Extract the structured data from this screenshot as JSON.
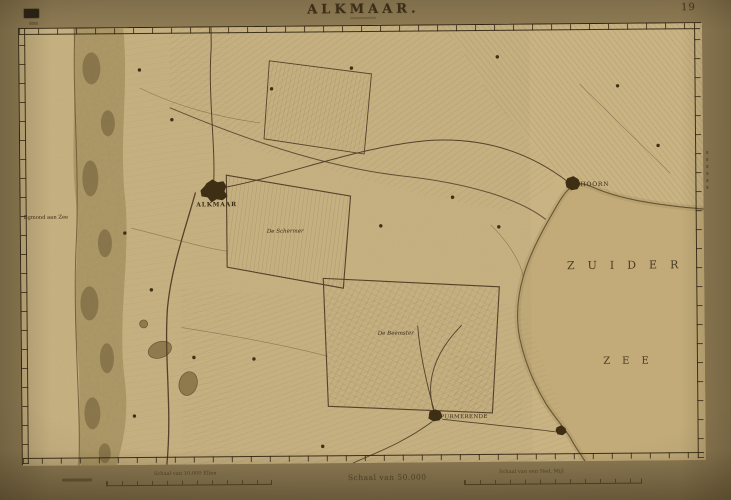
{
  "sheet": {
    "title": "ALKMAAR.",
    "sheet_number": "19"
  },
  "scales": {
    "left": "Schaal van 10.000 Ellen",
    "center": "Schaal van 50.000",
    "right": "Schaal van een Ned. Mijl"
  },
  "map": {
    "sea": {
      "line1": "ZUIDER",
      "line2": "ZEE"
    },
    "labels": {
      "alkmaar": "ALKMAAR",
      "hoorn": "HOORN",
      "purmerende": "PURMERENDE",
      "egmond": "Egmond aan Zee",
      "schermer": "De Schermer",
      "beemster": "De Beemster"
    },
    "colors": {
      "paper": "#c9b383",
      "sea": "#c2ab79",
      "ink": "#3a2b14",
      "terrain": "#6d5a38",
      "frame": "#2e2310"
    }
  }
}
